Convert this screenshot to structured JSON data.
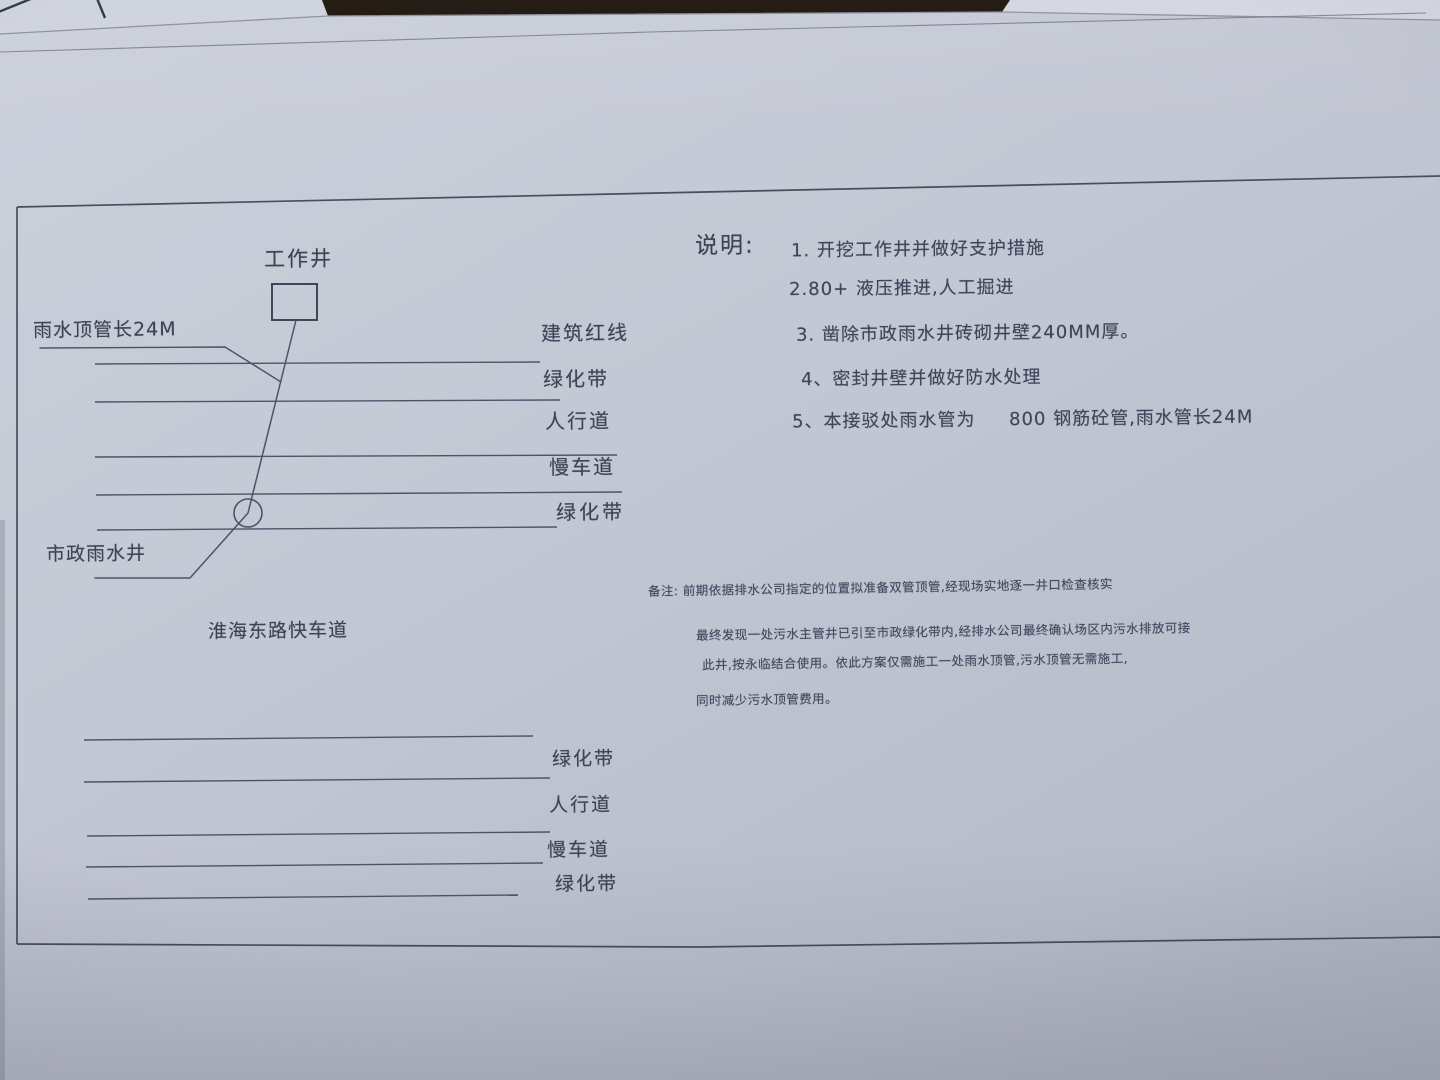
{
  "photo": {
    "desk_color": "#1a1109",
    "paper_color": "#c4c8d4",
    "pencil_line_color": "#4e536a",
    "ink_color": "#3d4357"
  },
  "diagram": {
    "work_shaft_label": "工作井",
    "rain_pipe_label": "雨水顶管长24M",
    "municipal_well_label": "市政雨水井",
    "road_label": "淮海东路快车道",
    "upper_zones": [
      "建筑红线",
      "绿化带",
      "人行道",
      "慢车道",
      "绿化带"
    ],
    "lower_zones": [
      "绿化带",
      "人行道",
      "慢车道",
      "绿化带"
    ]
  },
  "notes": {
    "title": "说明:",
    "items": [
      "1. 开挖工作井并做好支护措施",
      "2.80+ 液压推进,人工掘进",
      "3. 凿除市政雨水井砖砌井壁240MM厚。",
      "4、密封井壁并做好防水处理",
      "5、本接驳处雨水管为     800 钢筋砼管,雨水管长24M"
    ]
  },
  "remark": {
    "lines": [
      "备注: 前期依据排水公司指定的位置拟准备双管顶管,经现场实地逐一井口检查核实",
      "最终发现一处污水主管井已引至市政绿化带内,经排水公司最终确认场区内污水排放可接",
      "此井,按永临结合使用。依此方案仅需施工一处雨水顶管,污水顶管无需施工,",
      "同时减少污水顶管费用。"
    ]
  }
}
